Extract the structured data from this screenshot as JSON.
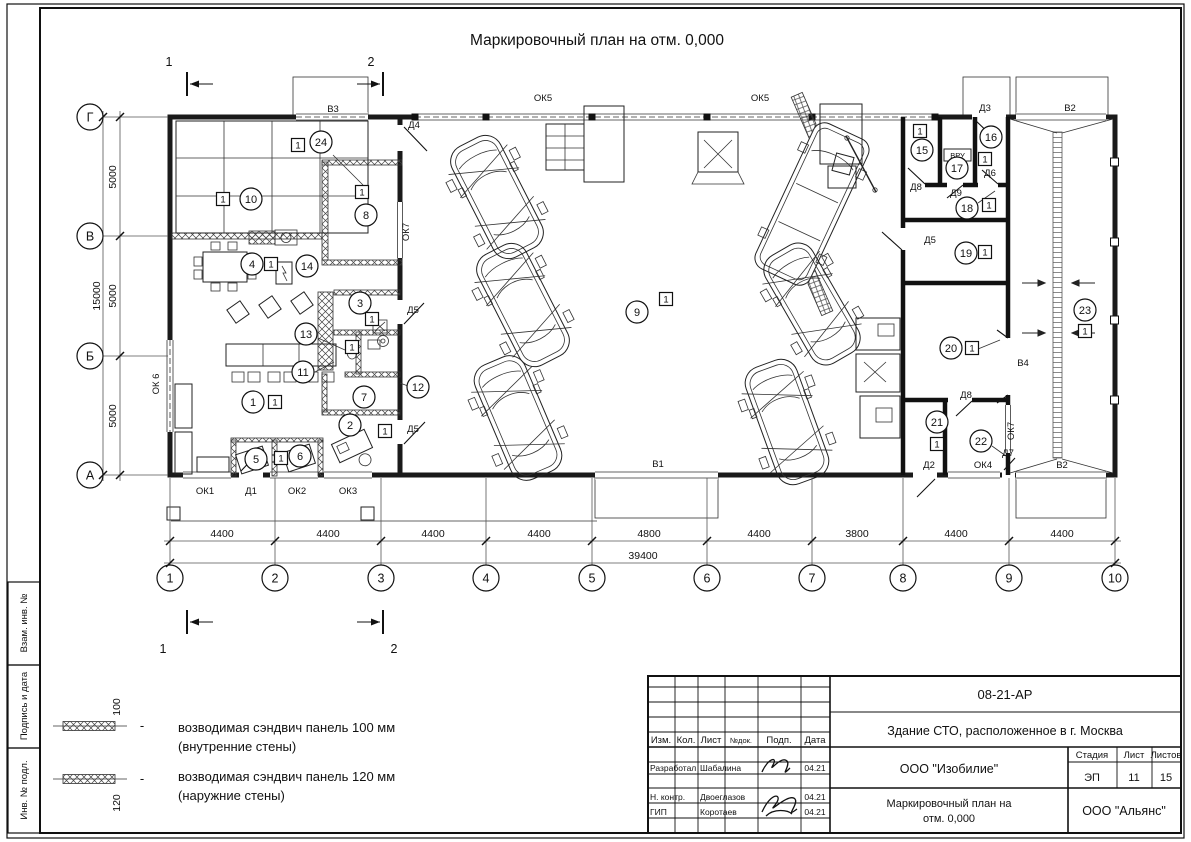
{
  "sheet": {
    "title": "Маркировочный план на отм. 0,000",
    "frame_labels": [
      "Взам. инв. №",
      "Подпись и дата",
      "Инв. № подл."
    ]
  },
  "legend": {
    "dash": "-",
    "items": [
      {
        "dim": "100",
        "line1": "возводимая сэндвич панель 100 мм",
        "line2": "(внутренние стены)"
      },
      {
        "dim": "120",
        "line1": "возводимая сэндвич панель 120 мм",
        "line2": "(наружние стены)"
      }
    ]
  },
  "title_block": {
    "doc_code": "08-21-АР",
    "project_title": "Здание СТО, расположенное в г. Москва",
    "columns": [
      "Изм.",
      "Кол.",
      "Лист",
      "№док.",
      "Подп.",
      "Дата"
    ],
    "company": "ООО \"Изобилие\"",
    "stage_label": "Стадия",
    "sheet_label": "Лист",
    "sheets_label": "Листов",
    "stage": "ЭП",
    "sheet_no": "11",
    "sheets_total": "15",
    "drawing_title_line1": "Маркировочный план на",
    "drawing_title_line2": "отм. 0,000",
    "org": "ООО \"Альянс\"",
    "roles": [
      {
        "role": "Разработал",
        "name": "Шабалина",
        "date": "04.21"
      },
      {
        "role": "Н. контр.",
        "name": "Двоеглазов",
        "date": "04.21"
      },
      {
        "role": "ГИП",
        "name": "Коротаев",
        "date": "04.21"
      }
    ]
  },
  "plan": {
    "unit_label": "1",
    "vru_label": "ВРУ",
    "dim_total": "39400",
    "dim_left_total": "15000",
    "axes_x": [
      {
        "label": "1",
        "pos": 170
      },
      {
        "label": "2",
        "pos": 275
      },
      {
        "label": "3",
        "pos": 381
      },
      {
        "label": "4",
        "pos": 486
      },
      {
        "label": "5",
        "pos": 592
      },
      {
        "label": "6",
        "pos": 707
      },
      {
        "label": "7",
        "pos": 812
      },
      {
        "label": "8",
        "pos": 903
      },
      {
        "label": "9",
        "pos": 1009
      },
      {
        "label": "10",
        "pos": 1115
      }
    ],
    "axes_y": [
      {
        "label": "Г",
        "pos": 117
      },
      {
        "label": "В",
        "pos": 236
      },
      {
        "label": "Б",
        "pos": 356
      },
      {
        "label": "А",
        "pos": 475
      }
    ],
    "dims_bottom": [
      {
        "text": "4400",
        "x": 222
      },
      {
        "text": "4400",
        "x": 328
      },
      {
        "text": "4400",
        "x": 433
      },
      {
        "text": "4400",
        "x": 539
      },
      {
        "text": "4800",
        "x": 649
      },
      {
        "text": "4400",
        "x": 759
      },
      {
        "text": "3800",
        "x": 857
      },
      {
        "text": "4400",
        "x": 956
      },
      {
        "text": "4400",
        "x": 1062
      }
    ],
    "dims_left": [
      {
        "text": "5000",
        "y": 177
      },
      {
        "text": "5000",
        "y": 296
      },
      {
        "text": "5000",
        "y": 416
      }
    ],
    "rooms": [
      {
        "n": "1",
        "x": 253,
        "y": 402
      },
      {
        "n": "2",
        "x": 350,
        "y": 425
      },
      {
        "n": "3",
        "x": 360,
        "y": 303
      },
      {
        "n": "4",
        "x": 252,
        "y": 264
      },
      {
        "n": "5",
        "x": 256,
        "y": 459
      },
      {
        "n": "6",
        "x": 300,
        "y": 456
      },
      {
        "n": "7",
        "x": 364,
        "y": 397
      },
      {
        "n": "8",
        "x": 366,
        "y": 215
      },
      {
        "n": "9",
        "x": 637,
        "y": 312
      },
      {
        "n": "10",
        "x": 251,
        "y": 199
      },
      {
        "n": "11",
        "x": 303,
        "y": 372
      },
      {
        "n": "12",
        "x": 418,
        "y": 387
      },
      {
        "n": "13",
        "x": 306,
        "y": 334
      },
      {
        "n": "14",
        "x": 307,
        "y": 266
      },
      {
        "n": "15",
        "x": 922,
        "y": 150
      },
      {
        "n": "16",
        "x": 991,
        "y": 137
      },
      {
        "n": "17",
        "x": 957,
        "y": 168
      },
      {
        "n": "18",
        "x": 967,
        "y": 208
      },
      {
        "n": "19",
        "x": 966,
        "y": 253
      },
      {
        "n": "20",
        "x": 951,
        "y": 348
      },
      {
        "n": "21",
        "x": 937,
        "y": 422
      },
      {
        "n": "22",
        "x": 981,
        "y": 441
      },
      {
        "n": "23",
        "x": 1085,
        "y": 310
      },
      {
        "n": "24",
        "x": 321,
        "y": 142
      }
    ],
    "unit_marks": [
      {
        "x": 275,
        "y": 402
      },
      {
        "x": 385,
        "y": 431
      },
      {
        "x": 372,
        "y": 319
      },
      {
        "x": 352,
        "y": 347
      },
      {
        "x": 271,
        "y": 264
      },
      {
        "x": 281,
        "y": 458
      },
      {
        "x": 362,
        "y": 192
      },
      {
        "x": 666,
        "y": 299
      },
      {
        "x": 223,
        "y": 199
      },
      {
        "x": 920,
        "y": 131
      },
      {
        "x": 985,
        "y": 159
      },
      {
        "x": 989,
        "y": 205
      },
      {
        "x": 985,
        "y": 252
      },
      {
        "x": 972,
        "y": 348
      },
      {
        "x": 937,
        "y": 444
      },
      {
        "x": 1085,
        "y": 331
      },
      {
        "x": 298,
        "y": 145
      }
    ],
    "openings": [
      {
        "t": "ОК5",
        "x": 543,
        "y": 101
      },
      {
        "t": "ОК5",
        "x": 760,
        "y": 101
      },
      {
        "t": "В3",
        "x": 333,
        "y": 112
      },
      {
        "t": "Д4",
        "x": 414,
        "y": 128
      },
      {
        "t": "Д3",
        "x": 985,
        "y": 111
      },
      {
        "t": "В2",
        "x": 1070,
        "y": 111
      },
      {
        "t": "Д8",
        "x": 916,
        "y": 190
      },
      {
        "t": "Д9",
        "x": 956,
        "y": 196
      },
      {
        "t": "Д6",
        "x": 990,
        "y": 176
      },
      {
        "t": "Д5",
        "x": 930,
        "y": 243
      },
      {
        "t": "Д5",
        "x": 413,
        "y": 313
      },
      {
        "t": "Д5",
        "x": 413,
        "y": 432
      },
      {
        "t": "ОК7",
        "x": 409,
        "y": 232,
        "v": true
      },
      {
        "t": "ОК7",
        "x": 1014,
        "y": 431,
        "v": true
      },
      {
        "t": "Д8",
        "x": 966,
        "y": 398
      },
      {
        "t": "В4",
        "x": 1023,
        "y": 366
      },
      {
        "t": "Д7",
        "x": 1008,
        "y": 456
      },
      {
        "t": "ОК4",
        "x": 983,
        "y": 468
      },
      {
        "t": "Д2",
        "x": 929,
        "y": 468
      },
      {
        "t": "В1",
        "x": 658,
        "y": 467
      },
      {
        "t": "ОК1",
        "x": 205,
        "y": 494
      },
      {
        "t": "Д1",
        "x": 251,
        "y": 494
      },
      {
        "t": "ОК2",
        "x": 297,
        "y": 494
      },
      {
        "t": "ОК3",
        "x": 348,
        "y": 494
      },
      {
        "t": "ОК 6",
        "x": 159,
        "y": 384,
        "v": true
      },
      {
        "t": "В2",
        "x": 1062,
        "y": 468
      }
    ],
    "section_marks": [
      {
        "t": "1",
        "x": 169,
        "y": 66
      },
      {
        "t": "2",
        "x": 371,
        "y": 66
      },
      {
        "t": "1",
        "x": 163,
        "y": 653
      },
      {
        "t": "2",
        "x": 394,
        "y": 653
      }
    ]
  }
}
